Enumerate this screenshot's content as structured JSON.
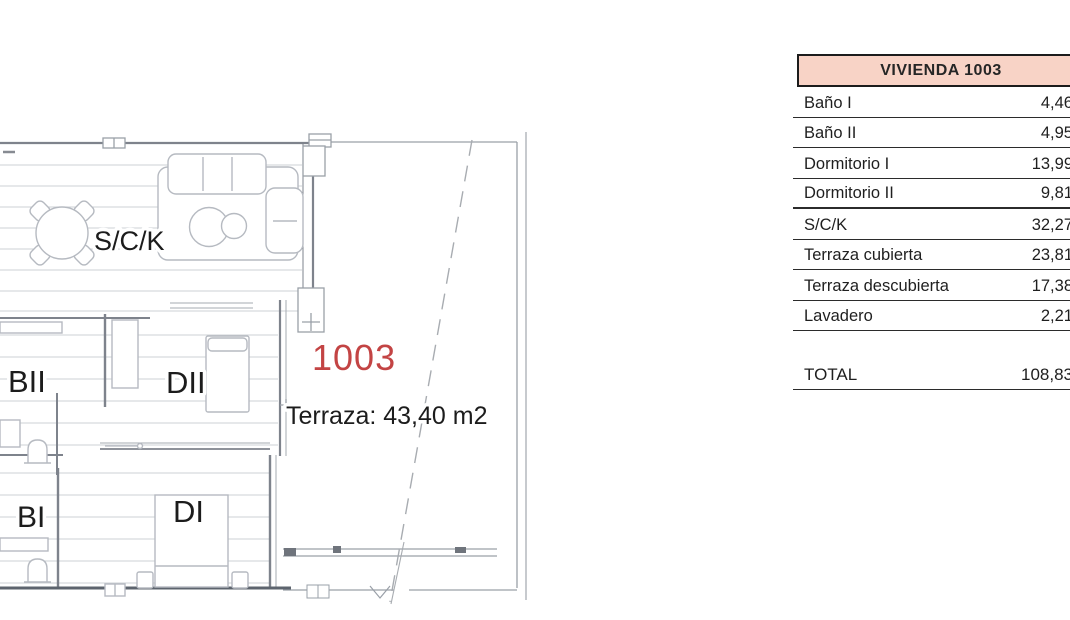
{
  "plan": {
    "unit_number": "1003",
    "unit_number_color": "#c34444",
    "terrace_note": "Terraza: 43,40 m2",
    "rooms": {
      "sck": "S/C/K",
      "banio2": "BII",
      "dorm2": "DII",
      "banio1": "BI",
      "dorm1": "DI"
    }
  },
  "table": {
    "title": "VIVIENDA 1003",
    "header_bg": "#f8d3c6",
    "rows": [
      {
        "label": "Baño I",
        "value": "4,46"
      },
      {
        "label": "Baño II",
        "value": "4,95"
      },
      {
        "label": "Dormitorio I",
        "value": "13,99"
      },
      {
        "label": "Dormitorio II",
        "value": "9,81"
      },
      {
        "label": "S/C/K",
        "value": "32,27"
      },
      {
        "label": "Terraza cubierta",
        "value": "23,81"
      },
      {
        "label": "Terraza descubierta",
        "value": "17,38"
      },
      {
        "label": "Lavadero",
        "value": "2,21"
      }
    ],
    "total": {
      "label": "TOTAL",
      "value": "108,83"
    }
  }
}
